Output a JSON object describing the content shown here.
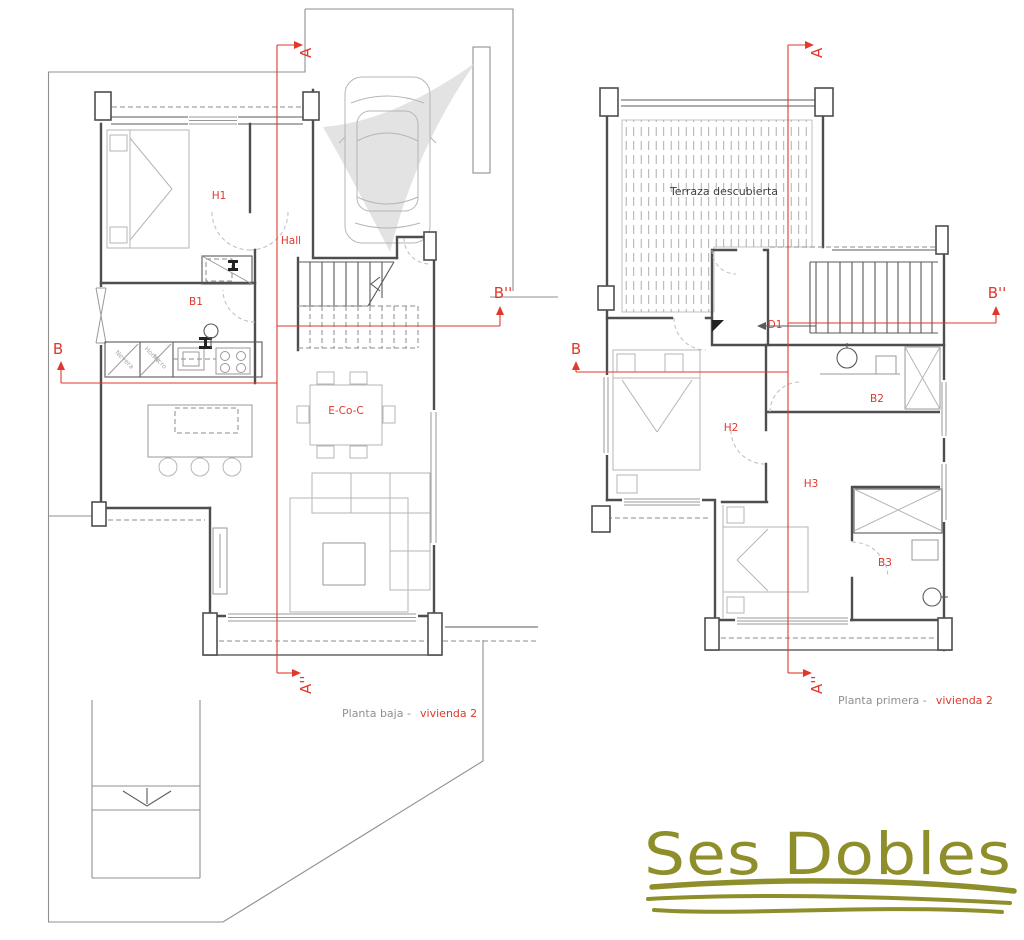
{
  "colors": {
    "red": "#e2382c",
    "olive": "#8e8e2b",
    "wall": "#4e4e4e",
    "furn": "#b6b6b6",
    "bound": "#8f8f8f"
  },
  "ground_floor": {
    "section_markers": {
      "a_top": "A",
      "a_bottom": "A''",
      "b_left": "B",
      "b_right": "B''"
    },
    "room_labels": {
      "h1": "H1",
      "hall": "Hall",
      "b1": "B1",
      "living_dining": "E-Co-C"
    },
    "kitchen_labels": {
      "fridge": "Nevera",
      "oven_line1": "Horno",
      "oven_line2": "Micro"
    },
    "caption": {
      "prefix": "Planta baja -",
      "highlight": "vivienda 2"
    }
  },
  "first_floor": {
    "section_markers": {
      "a_top": "A",
      "a_bottom": "A''",
      "b_left": "B",
      "b_right": "B''"
    },
    "room_labels": {
      "terrace": "Terraza descubierta",
      "d1": "D1",
      "h2": "H2",
      "b2": "B2",
      "h3": "H3",
      "b3": "B3"
    },
    "caption": {
      "prefix": "Planta primera -",
      "highlight": "vivienda 2"
    }
  },
  "logo": {
    "text": "Ses Dobles"
  }
}
